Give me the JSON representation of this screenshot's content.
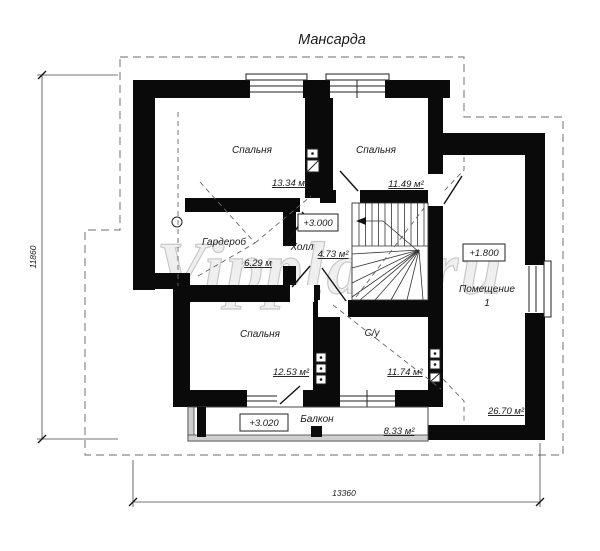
{
  "title": "Мансарда",
  "watermark": "Vipplan.ru",
  "rooms": {
    "bedroom1": {
      "label": "Спальня",
      "area": "13.34 м²"
    },
    "bedroom2": {
      "label": "Спальня",
      "area": "11.49 м²"
    },
    "wardrobe": {
      "label": "Гардероб",
      "area": "6.29 м"
    },
    "hall": {
      "label": "Холл",
      "area": "4.73 м²",
      "elevation": "+3.000"
    },
    "room1": {
      "label": "Помещение",
      "number": "1",
      "area": "26.70 м²",
      "elevation": "+1.800"
    },
    "bedroom3": {
      "label": "Спальня",
      "area": "12.53 м²"
    },
    "bathroom": {
      "label": "С/у",
      "area": "11.74 м²"
    },
    "balcony": {
      "label": "Балкон",
      "area": "8.33 м²",
      "elevation": "+3.020"
    }
  },
  "dimensions": {
    "width": "13360",
    "height": "11860"
  },
  "colors": {
    "walls": "#0a0a0a",
    "roof_dash": "#8a8a8a",
    "text": "#1b1b1b",
    "watermark": "#e9e9e9"
  }
}
